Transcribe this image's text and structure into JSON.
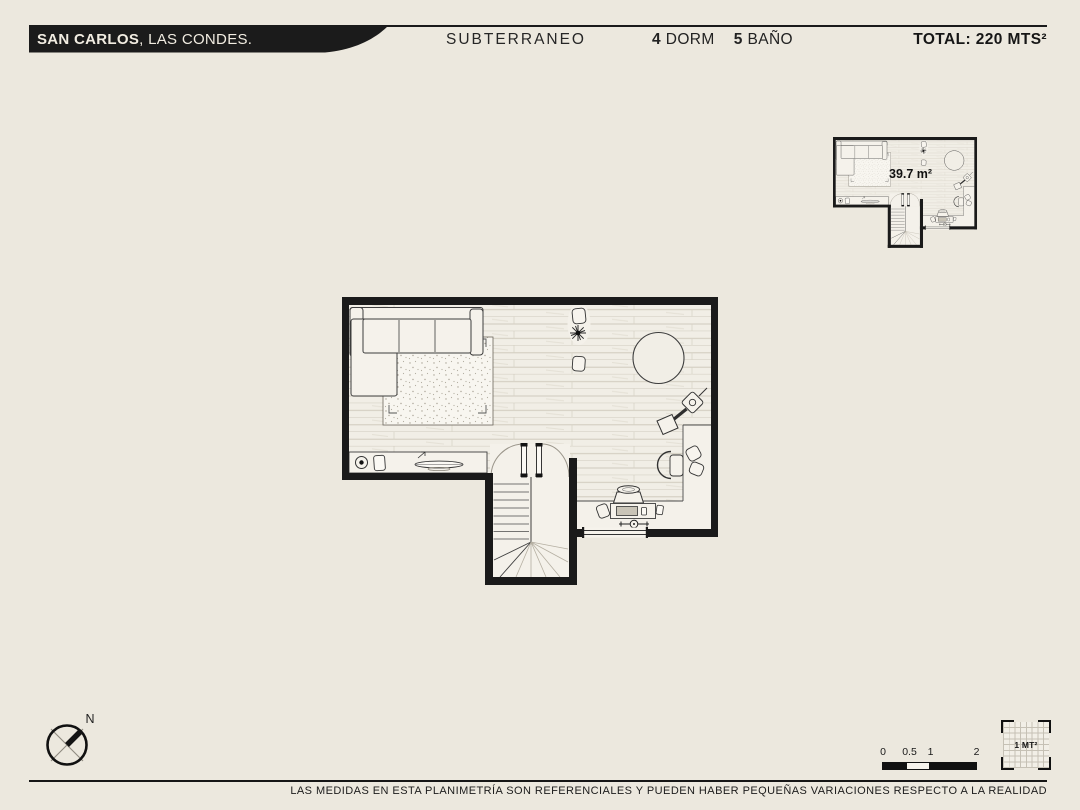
{
  "header": {
    "project_bold": "SAN CARLOS",
    "project_rest": ", LAS CONDES.",
    "level": "SUBTERRANEO",
    "bedrooms_count": "4",
    "bedrooms_label": "DORM",
    "bathrooms_count": "5",
    "bathrooms_label": "BAÑO",
    "total_label": "TOTAL: 220 MTS²"
  },
  "plan": {
    "area_label": "39.7 m²",
    "furniture": [
      "sectional-sofa",
      "rug",
      "media-shelf",
      "speaker",
      "side-table-pair",
      "plant",
      "round-table",
      "floor-lamp",
      "desk",
      "desk-chair",
      "pouf-pair",
      "stove",
      "record-console",
      "winder-staircase",
      "window",
      "door-swing-arcs"
    ]
  },
  "compass": {
    "north_label": "N"
  },
  "scale_bar": {
    "ticks": [
      "0",
      "0.5",
      "1",
      "2"
    ]
  },
  "grid_legend": {
    "label": "1 MT²"
  },
  "footer": {
    "disclaimer": "LAS MEDIDAS EN ESTA PLANIMETRÍA SON REFERENCIALES Y PUEDEN HABER PEQUEÑAS VARIACIONES RESPECTO A LA REALIDAD"
  },
  "colors": {
    "background": "#ece8de",
    "wall": "#1a1a1a",
    "banner": "#1b1b1b",
    "floor": "#f1eee6",
    "text": "#1d1d1d"
  }
}
